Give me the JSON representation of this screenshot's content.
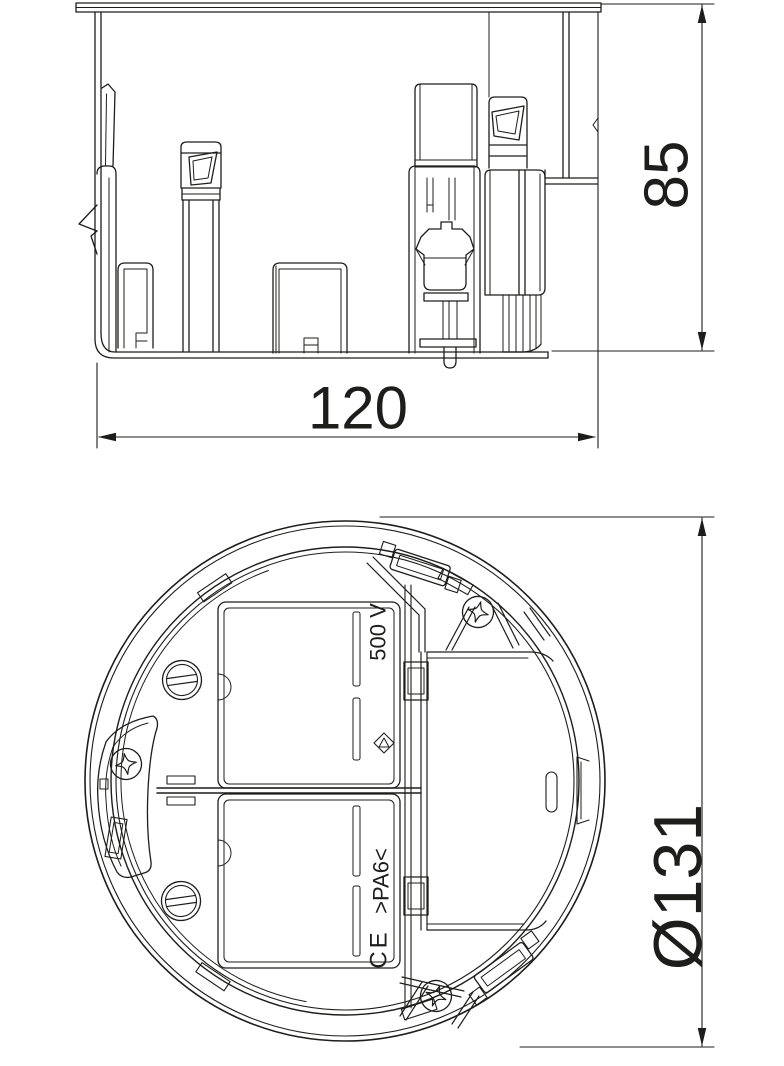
{
  "page": {
    "background": "#ffffff",
    "line_color": "#1d1d1b"
  },
  "side_view": {
    "width_dimension": "120",
    "height_dimension": "85"
  },
  "plan_view": {
    "diameter_dimension": "Ø131",
    "markings": {
      "voltage_rating": "500 V",
      "material_code": ">PA6<",
      "ce_mark": "CE"
    }
  }
}
